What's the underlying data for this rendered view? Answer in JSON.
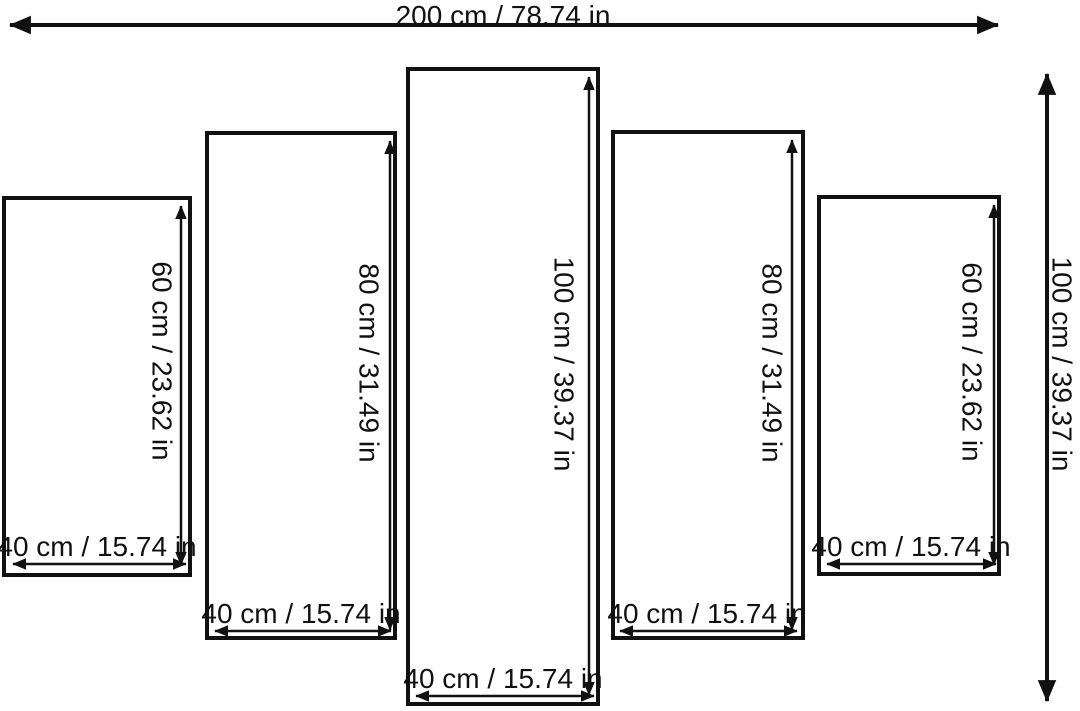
{
  "overall": {
    "width_label": "200 cm / 78.74 in",
    "height_label": "100 cm / 39.37 in",
    "width_cm": 200,
    "width_in": 78.74,
    "height_cm": 100,
    "height_in": 39.37
  },
  "panels": [
    {
      "position": "far-left",
      "height_label": "60 cm / 23.62 in",
      "width_label": "40 cm / 15.74 in",
      "height_cm": 60,
      "height_in": 23.62,
      "width_cm": 40,
      "width_in": 15.74
    },
    {
      "position": "left",
      "height_label": "80 cm / 31.49 in",
      "width_label": "40 cm / 15.74 in",
      "height_cm": 80,
      "height_in": 31.49,
      "width_cm": 40,
      "width_in": 15.74
    },
    {
      "position": "center",
      "height_label": "100 cm / 39.37 in",
      "width_label": "40 cm / 15.74 in",
      "height_cm": 100,
      "height_in": 39.37,
      "width_cm": 40,
      "width_in": 15.74
    },
    {
      "position": "right",
      "height_label": "80 cm / 31.49 in",
      "width_label": "40 cm / 15.74 in",
      "height_cm": 80,
      "height_in": 31.49,
      "width_cm": 40,
      "width_in": 15.74
    },
    {
      "position": "far-right",
      "height_label": "60 cm / 23.62 in",
      "width_label": "40 cm / 15.74 in",
      "height_cm": 60,
      "height_in": 23.62,
      "width_cm": 40,
      "width_in": 15.74
    }
  ],
  "colors": {
    "line": "#111111",
    "background": "#ffffff"
  }
}
